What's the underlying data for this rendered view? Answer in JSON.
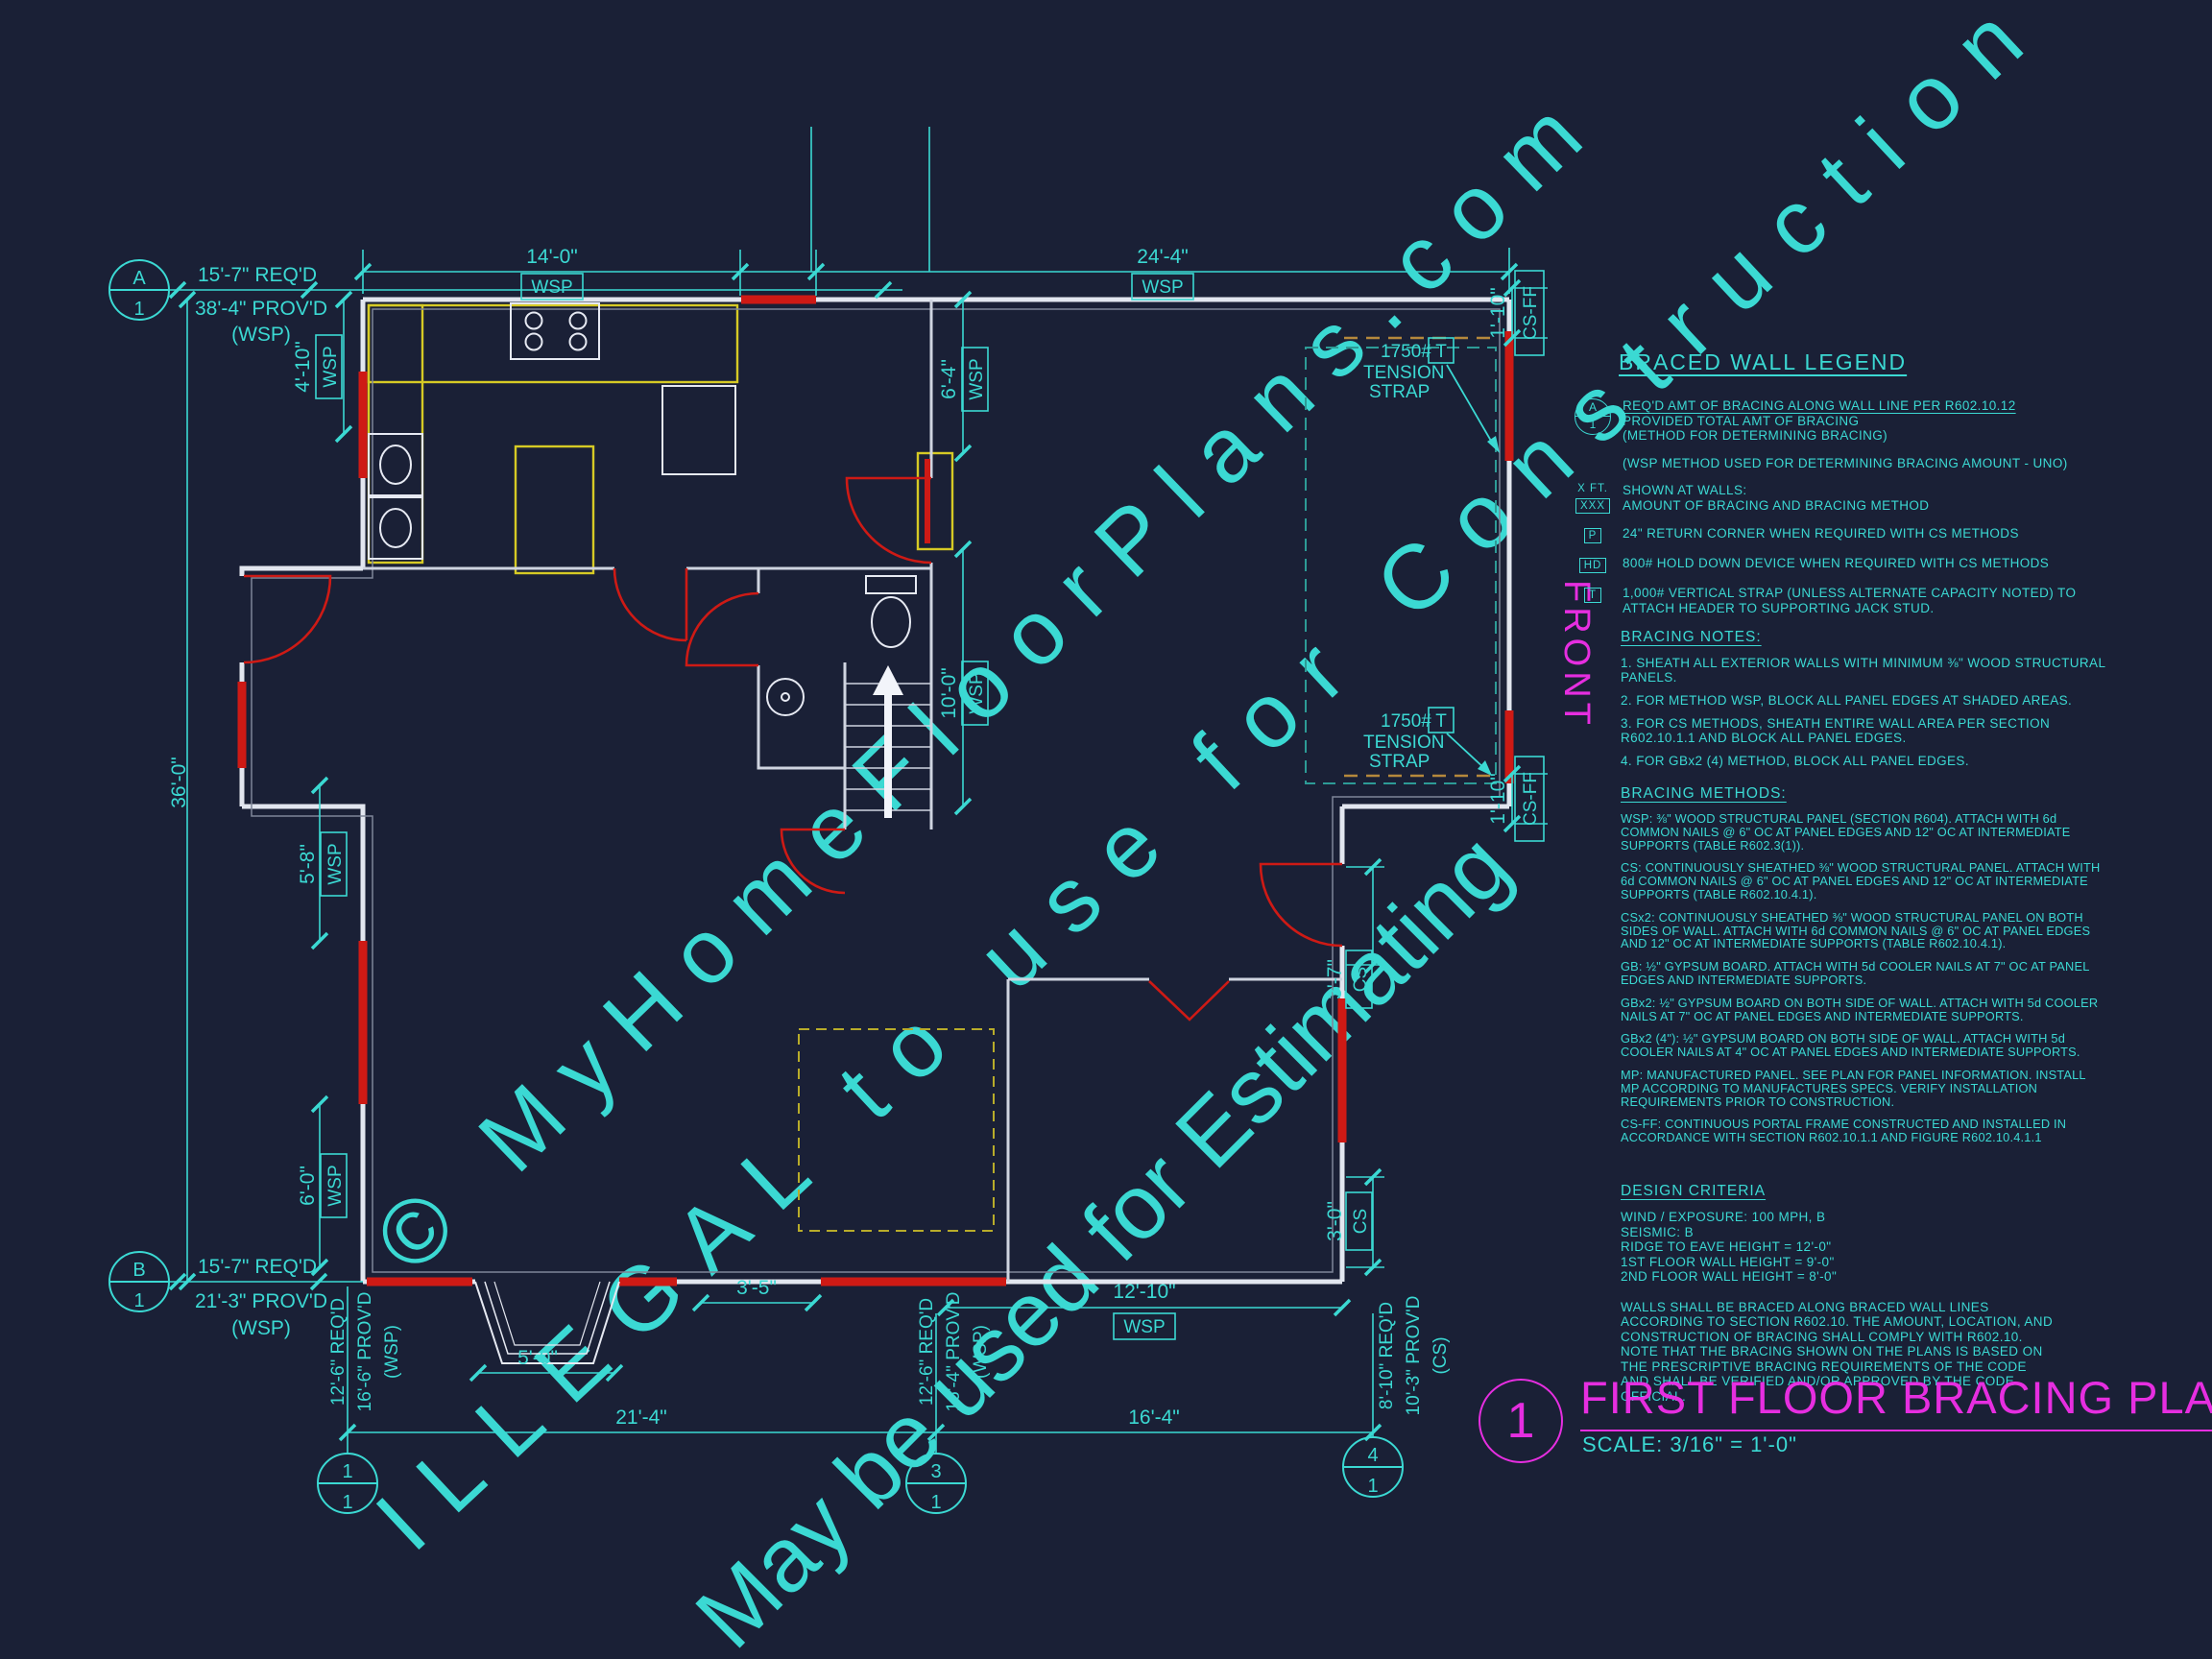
{
  "colors": {
    "background": "#1a2036",
    "cyan": "#3bd9d3",
    "magenta": "#e62ee0",
    "bracing_red": "#ce1a15",
    "cabinet_yellow": "#d6ca25",
    "wall_white": "#e2e6ef",
    "watermark_gray": "#c8cede"
  },
  "watermark": {
    "line1": "© MyHomeFloorPlans.com",
    "line2": "ILLEGAL to use for Construction",
    "line3": "May be used for Estimating"
  },
  "front_label": "FRONT",
  "grid": {
    "a_top": "A",
    "a_bottom": "1",
    "b_top": "B",
    "b_bottom": "1",
    "g1_top": "1",
    "g1_bottom": "1",
    "g3_top": "3",
    "g3_bottom": "1",
    "g4_top": "4",
    "g4_bottom": "1"
  },
  "tags": {
    "wsp": "WSP",
    "cs": "CS",
    "cs_ff": "CS-FF"
  },
  "strap": {
    "capacity": "1750#",
    "tag": "T",
    "word1": "TENSION",
    "word2": "STRAP"
  },
  "dims": {
    "a_req": "15'-7\" REQ'D",
    "a_prov": "38'-4\" PROV'D",
    "a_method": "(WSP)",
    "b_req": "15'-7\" REQ'D",
    "b_prov": "21'-3\" PROV'D",
    "b_method": "(WSP)",
    "top_left_span": "14'-0\"",
    "top_right_span": "24'-4\"",
    "left_height": "36'-0\"",
    "left_seg1": "4'-10\"",
    "left_seg2": "5'-8\"",
    "left_seg3": "6'-0\"",
    "mid_seg1": "6'-4\"",
    "mid_seg2": "10'-0\"",
    "right_seg1": "3'-7\"",
    "right_seg2": "3'-0\"",
    "corner_top": "1'-10\"",
    "corner_bottom": "1'-10\"",
    "stair_width": "3'-5\"",
    "bay_width": "5'-0\"",
    "bottom_right_span": "12'-10\"",
    "grid_span_13": "21'-4\"",
    "grid_span_34": "16'-4\"",
    "col1_req": "12'-6\" REQ'D",
    "col1_prov": "16'-6\" PROV'D",
    "col1_method": "(WSP)",
    "col3_req": "12'-6\" REQ'D",
    "col3_prov": "16'-4\" PROV'D",
    "col3_method": "(WSP)",
    "col4_req": "8'-10\" REQ'D",
    "col4_prov": "10'-3\" PROV'D",
    "col4_method": "(CS)"
  },
  "legend": {
    "title": "BRACED WALL LEGEND",
    "bubble_top": "A",
    "bubble_bottom": "1",
    "item1_line1": "REQ'D AMT OF BRACING ALONG WALL LINE PER R602.10.12",
    "item1_line2": "PROVIDED TOTAL AMT OF BRACING",
    "item1_line3": "(METHOD FOR DETERMINING BRACING)",
    "item2": "(WSP METHOD USED FOR DETERMINING BRACING AMOUNT - UNO)",
    "item3_marker_top": "X FT.",
    "item3_marker_bottom": "XXX",
    "item3_line1": "SHOWN AT WALLS:",
    "item3_line2": "AMOUNT OF BRACING AND BRACING METHOD",
    "item4_marker": "P",
    "item4": "24\" RETURN CORNER WHEN REQUIRED WITH CS METHODS",
    "item5_marker": "HD",
    "item5": "800# HOLD DOWN DEVICE WHEN REQUIRED WITH CS METHODS",
    "item6_marker": "T",
    "item6": "1,000# VERTICAL STRAP (UNLESS ALTERNATE CAPACITY NOTED) TO ATTACH HEADER TO SUPPORTING JACK STUD."
  },
  "notes": {
    "title": "BRACING NOTES:",
    "n1": "1. SHEATH ALL EXTERIOR WALLS WITH MINIMUM ⅜\" WOOD STRUCTURAL PANELS.",
    "n2": "2. FOR METHOD WSP, BLOCK ALL PANEL EDGES AT SHADED AREAS.",
    "n3": "3. FOR CS METHODS, SHEATH ENTIRE WALL AREA PER SECTION R602.10.1.1 AND BLOCK ALL PANEL EDGES.",
    "n4": "4. FOR GBx2 (4) METHOD, BLOCK ALL PANEL EDGES."
  },
  "methods": {
    "title": "BRACING METHODS:",
    "m1": "WSP: ⅜\" WOOD STRUCTURAL PANEL (SECTION R604). ATTACH WITH 6d COMMON NAILS @ 6\" OC AT PANEL EDGES AND 12\" OC AT INTERMEDIATE SUPPORTS (TABLE R602.3(1)).",
    "m2": "CS: CONTINUOUSLY SHEATHED ⅜\" WOOD STRUCTURAL PANEL. ATTACH WITH 6d COMMON NAILS @ 6\" OC AT PANEL EDGES AND 12\" OC AT INTERMEDIATE SUPPORTS (TABLE R602.10.4.1).",
    "m3": "CSx2: CONTINUOUSLY SHEATHED ⅜\" WOOD STRUCTURAL PANEL ON BOTH SIDES OF WALL. ATTACH WITH 6d COMMON NAILS @ 6\" OC AT PANEL EDGES AND 12\" OC AT INTERMEDIATE SUPPORTS (TABLE R602.10.4.1).",
    "m4": "GB: ½\" GYPSUM BOARD. ATTACH WITH 5d COOLER NAILS AT 7\" OC AT PANEL EDGES AND INTERMEDIATE SUPPORTS.",
    "m5": "GBx2: ½\" GYPSUM BOARD ON BOTH SIDE OF WALL. ATTACH WITH 5d COOLER NAILS AT 7\" OC AT PANEL EDGES AND INTERMEDIATE SUPPORTS.",
    "m6": "GBx2 (4\"): ½\" GYPSUM BOARD ON BOTH SIDE OF WALL. ATTACH WITH 5d COOLER NAILS AT 4\" OC AT PANEL EDGES AND INTERMEDIATE SUPPORTS.",
    "m7": "MP: MANUFACTURED PANEL. SEE PLAN FOR PANEL INFORMATION. INSTALL MP ACCORDING TO MANUFACTURES SPECS. VERIFY INSTALLATION REQUIREMENTS PRIOR TO CONSTRUCTION.",
    "m8": "CS-FF: CONTINUOUS PORTAL FRAME CONSTRUCTED AND INSTALLED IN ACCORDANCE WITH SECTION R602.10.1.1 AND FIGURE R602.10.4.1.1"
  },
  "criteria": {
    "title": "DESIGN CRITERIA",
    "c1": "WIND / EXPOSURE:  100 MPH, B",
    "c2": "SEISMIC:  B",
    "c3": "RIDGE TO EAVE HEIGHT = 12'-0\"",
    "c4": "1ST FLOOR WALL HEIGHT = 9'-0\"",
    "c5": "2ND FLOOR WALL HEIGHT = 8'-0\"",
    "paragraph": "WALLS SHALL BE BRACED ALONG BRACED WALL LINES ACCORDING TO SECTION R602.10. THE AMOUNT, LOCATION, AND CONSTRUCTION OF BRACING SHALL COMPLY WITH R602.10. NOTE THAT THE BRACING SHOWN ON THE PLANS IS BASED ON THE PRESCRIPTIVE BRACING REQUIREMENTS OF THE CODE AND SHALL BE VERIFIED AND/OR APPROVED BY THE CODE OFFICIAL."
  },
  "title_block": {
    "number": "1",
    "title": "FIRST FLOOR BRACING PLAN",
    "scale": "SCALE: 3/16\" = 1'-0\""
  }
}
